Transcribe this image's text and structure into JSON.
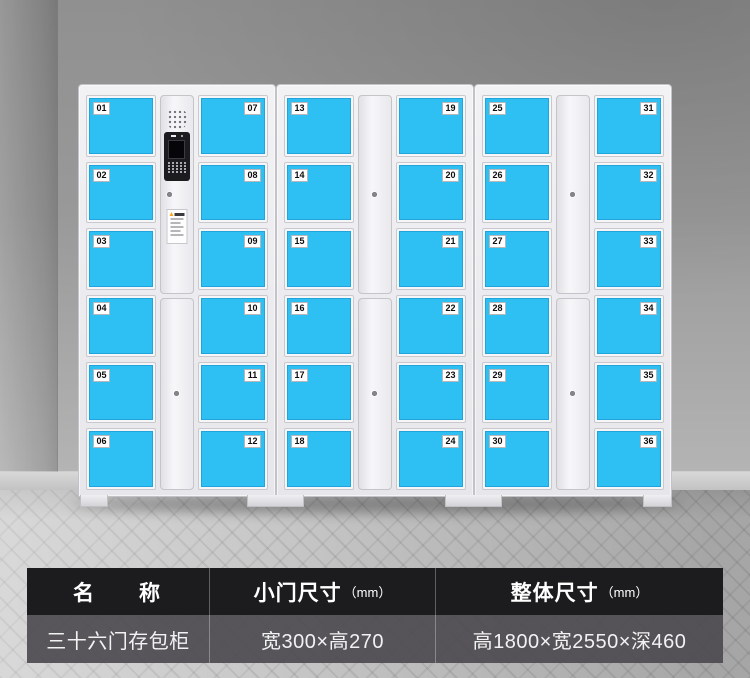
{
  "scene": {
    "subject": "36-door electronic storage locker product photo",
    "colors": {
      "door_blue": "#2fc0f3",
      "cabinet_body": "#ebebef",
      "wall_gray": "#9a9a9a",
      "floor_gray": "#c8c8c8",
      "table_header_bg": "#1c1c1e",
      "table_body_bg": "#5a585d",
      "warning_label_accent": "#f2a61c"
    }
  },
  "lockers": {
    "door_count": 36,
    "cabinets": [
      {
        "left_doors": [
          "01",
          "02",
          "03",
          "04",
          "05",
          "06"
        ],
        "right_doors": [
          "07",
          "08",
          "09",
          "10",
          "11",
          "12"
        ],
        "center": "control"
      },
      {
        "left_doors": [
          "13",
          "14",
          "15",
          "16",
          "17",
          "18"
        ],
        "right_doors": [
          "19",
          "20",
          "21",
          "22",
          "23",
          "24"
        ],
        "center": "plain"
      },
      {
        "left_doors": [
          "25",
          "26",
          "27",
          "28",
          "29",
          "30"
        ],
        "right_doors": [
          "31",
          "32",
          "33",
          "34",
          "35",
          "36"
        ],
        "center": "plain"
      }
    ]
  },
  "spec_table": {
    "headers": [
      {
        "title": "名　　称",
        "unit": ""
      },
      {
        "title": "小门尺寸",
        "unit": "（mm）"
      },
      {
        "title": "整体尺寸",
        "unit": "（mm）"
      }
    ],
    "row": [
      "三十六门存包柜",
      "宽300×高270",
      "高1800×宽2550×深460"
    ]
  }
}
